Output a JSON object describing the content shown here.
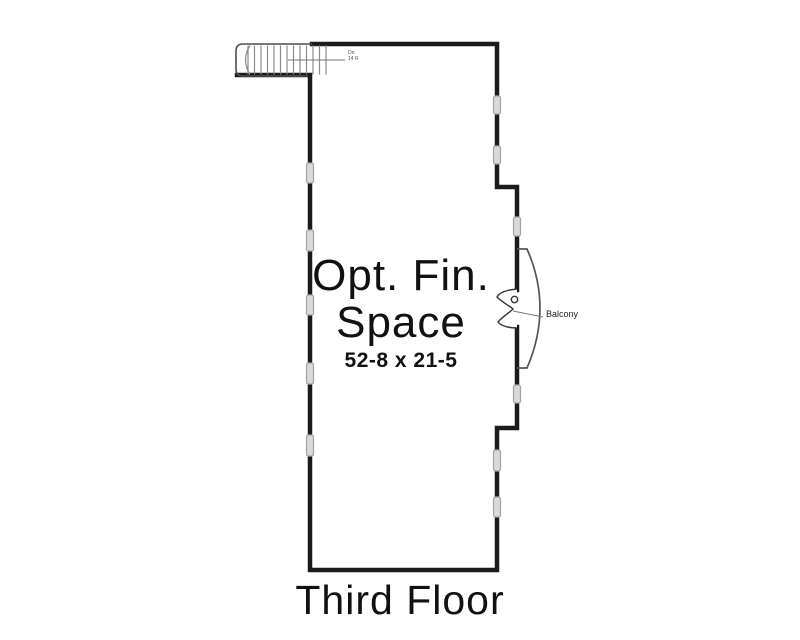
{
  "plan": {
    "title": "Third Floor",
    "room": {
      "name_line1": "Opt. Fin.",
      "name_line2": "Space",
      "dimensions": "52-8 x 21-5"
    },
    "balcony": {
      "label": "Balcony"
    },
    "stairs": {
      "label_line1": "Dn",
      "label_line2": "14 R"
    },
    "colors": {
      "wall": "#1b1b1b",
      "stair_line": "#8a8a8a",
      "stair_outline": "#4d4d4d",
      "window_fill": "#d9d9d9",
      "window_stroke": "#a3a3a3",
      "balcony_line": "#555555",
      "text": "#111111",
      "background": "#ffffff"
    }
  }
}
